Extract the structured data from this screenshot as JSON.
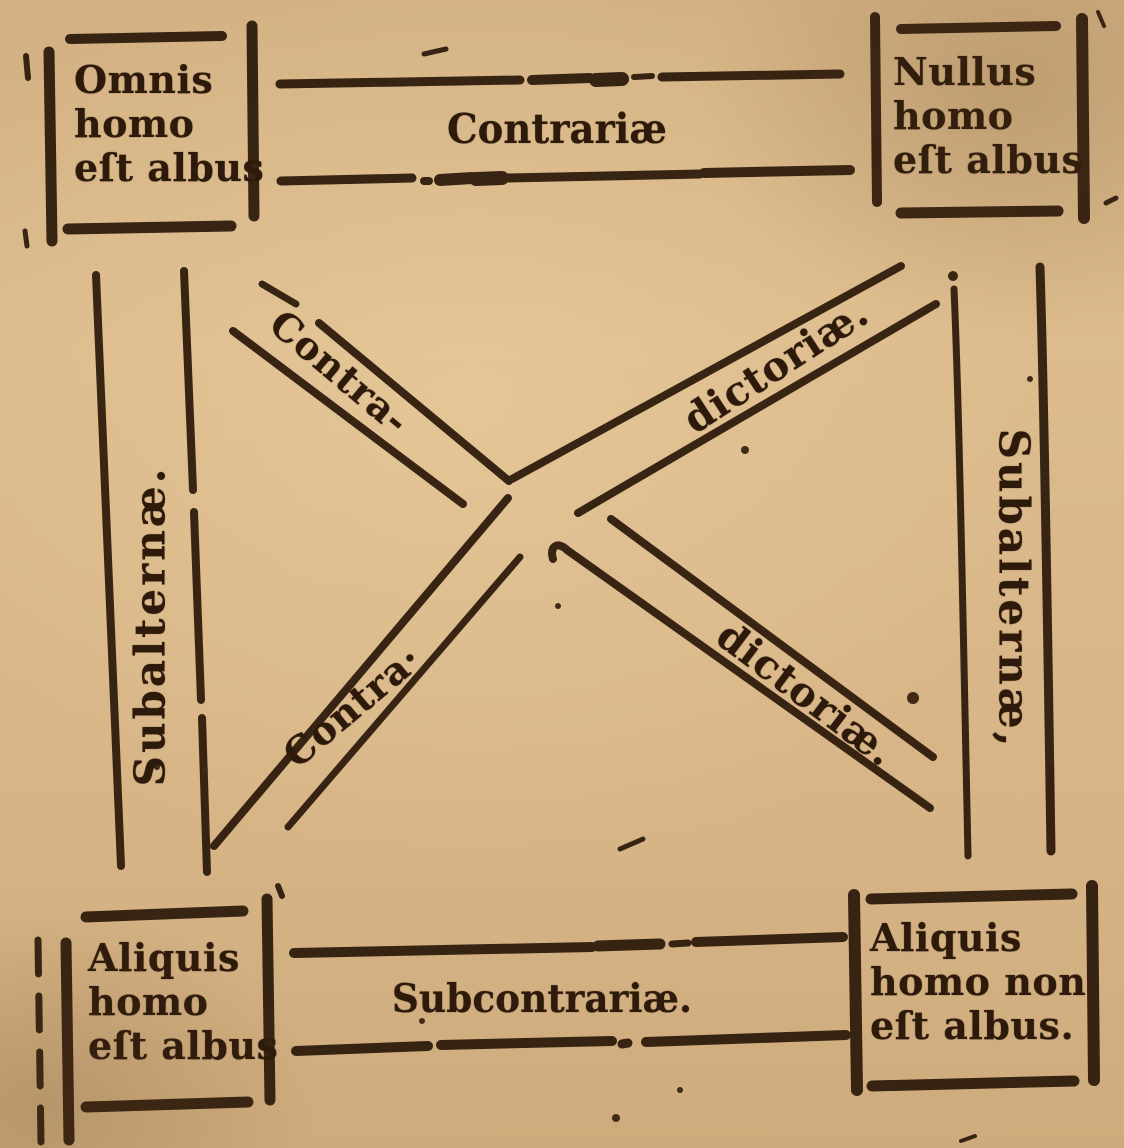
{
  "colors": {
    "paper": "#d7b486",
    "ink": "#311e0e"
  },
  "square": {
    "corners": {
      "top_left": {
        "lines": [
          "Omnis",
          "homo",
          "eſt albus"
        ]
      },
      "top_right": {
        "lines": [
          "Nullus",
          "homo",
          "eſt albus"
        ]
      },
      "bottom_left": {
        "lines": [
          "Aliquis",
          "homo",
          "eſt albus"
        ]
      },
      "bottom_right": {
        "lines": [
          "Aliquis",
          "homo non",
          "eſt albus."
        ]
      }
    },
    "relations": {
      "contrariae": "Contrariæ",
      "subcontrariae": "Subcontrariæ.",
      "subalternae_left": "Subalternæ.",
      "subalternae_right": "Subalternæ,",
      "contradictoriae_tlbr_first": "Contra-",
      "contradictoriae_tlbr_second": "dictoriæ.",
      "contradictoriae_bltr_first": "Contra·",
      "contradictoriae_bltr_second": "dictoriæ."
    }
  }
}
